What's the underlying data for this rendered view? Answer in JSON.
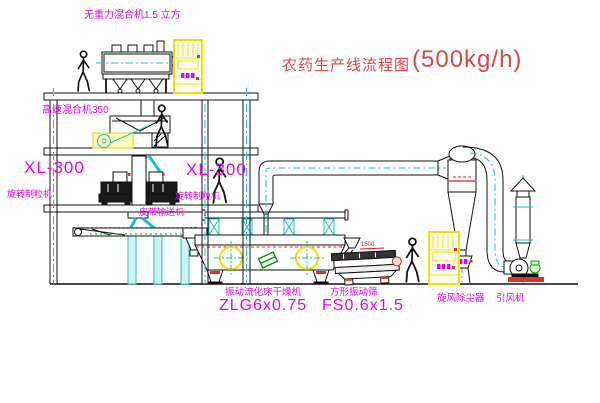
{
  "title": {
    "name": "农药生产线流程图",
    "capacity": "(500kg/h)"
  },
  "labels": {
    "gravity_mixer": "无重力混合机1.5 立方",
    "high_speed_mixer": "高速混合机350",
    "granulator_left_model": "XL-300",
    "granulator_left_name": "旋转制粒机",
    "granulator_right_model": "XL-300",
    "granulator_right_name": "旋转制粒机",
    "belt_conveyor": "皮带输送机",
    "dryer_name": "振动流化床干燥机",
    "dryer_model": "ZLG6x0.75",
    "sieve_name": "方形振动筛",
    "sieve_model": "FS0.6x1.5",
    "sieve_dim": "1500",
    "cyclone": "旋风除尘器",
    "fan": "引风机"
  },
  "colors": {
    "background": "#ffffff",
    "line": "#111111",
    "centerline_cyan": "#19c3c3",
    "label_magenta": "#ee00ee",
    "title_red": "#d84848",
    "cabinet_yellow": "#f0e400",
    "accent_red": "#e03030",
    "accent_green": "#00a000"
  }
}
